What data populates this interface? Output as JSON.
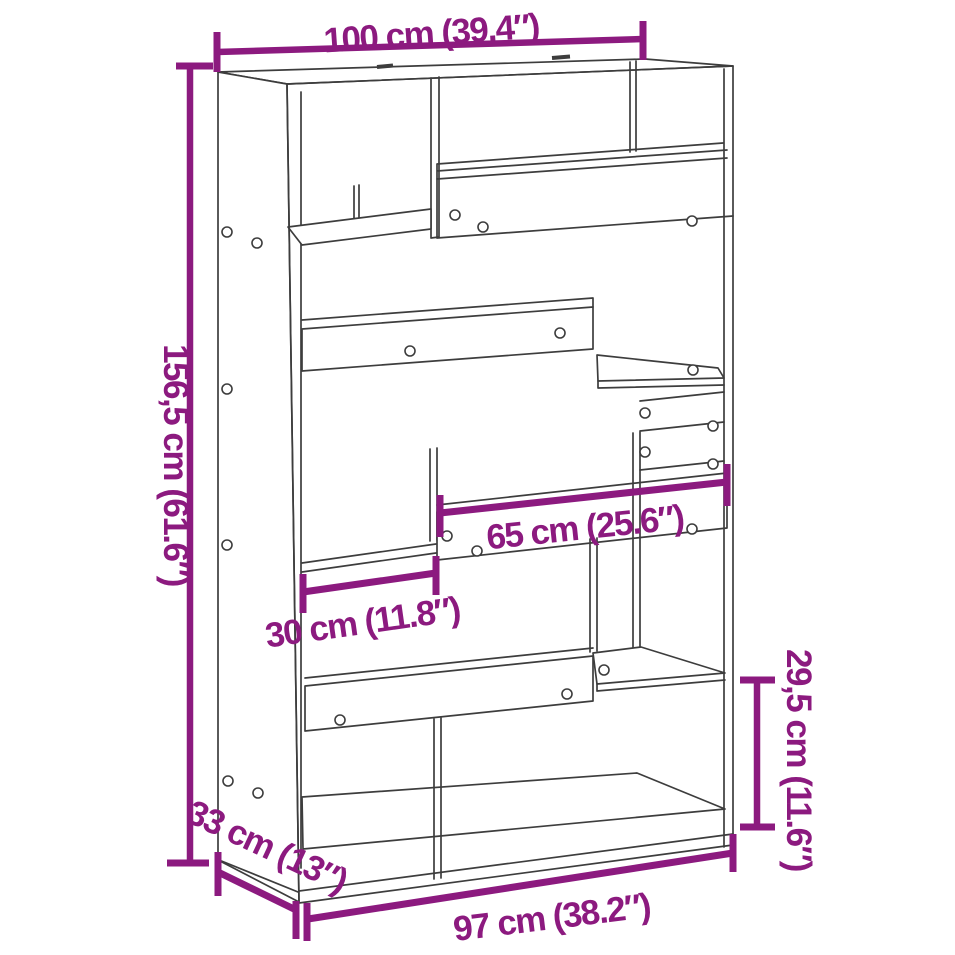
{
  "diagram": {
    "type": "product-dimension-diagram",
    "subject": "room divider bookcase line drawing",
    "colors": {
      "dimension_accent": "#8C1A7F",
      "drawing_line": "#3D3D3D",
      "background": "#FFFFFF"
    },
    "dimensions": {
      "width_top": "100 cm (39.4″)",
      "height_left": "156,5 cm (61.6″)",
      "shelf_width_middle": "65 cm (25.6″)",
      "shelf_width_small": "30 cm (11.8″)",
      "compartment_height_right": "29,5 cm (11.6″)",
      "depth_bottom": "33 cm (13″)",
      "width_bottom": "97 cm (38.2″)"
    }
  }
}
